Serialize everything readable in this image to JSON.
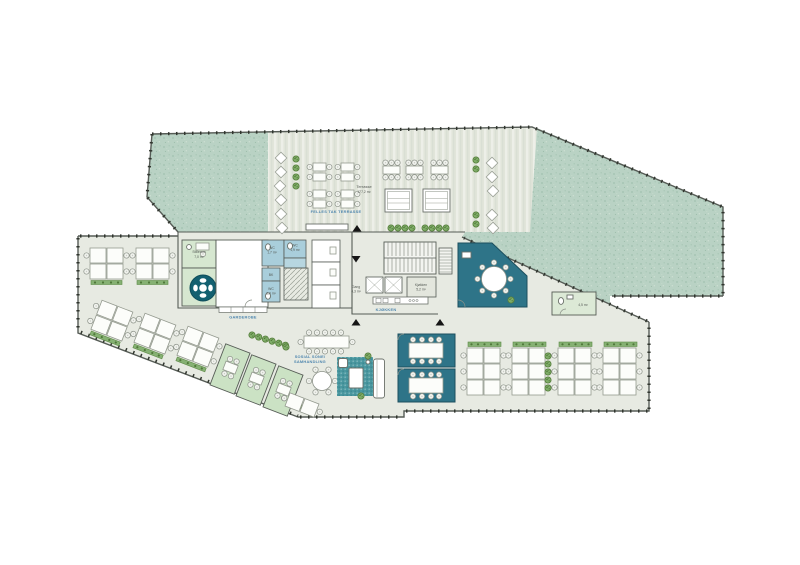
{
  "colors": {
    "roof_green": "#b9d2c4",
    "terrace_floor": "#e1e5da",
    "interior_floor": "#e7eae2",
    "meeting_teal": "#2e7488",
    "meeting_teal_dark": "#136070",
    "rug_teal": "#4b98a0",
    "wc_blue": "#a9cedb",
    "room_green": "#d6e7d0",
    "room_green_deep": "#cbe2c4",
    "plant_green": "#7fad68",
    "label_blue": "#4f86ae",
    "wall": "#565c56"
  },
  "labels": {
    "terrace": {
      "name": "Terrasse",
      "area": "177,2 m²"
    },
    "zones": {
      "terrace": "FELLES TAK TERRASSE",
      "wardrobe": "GARDEROBE",
      "kitchen": "KJØKKEN",
      "social_1": "SOSIAL SONE/",
      "social_2": "SAMHANDLING"
    },
    "rooms": {
      "quiet": {
        "name": "Stillerom",
        "area": "7,0 m²"
      },
      "kitchen": {
        "name": "Kjøkken",
        "area": "5,2 m²"
      },
      "wc_a": {
        "name": "WC",
        "area": "1,7 m²"
      },
      "wc_b": {
        "name": "WC",
        "area": "1,9 m²"
      },
      "wc_c": {
        "name": "WC",
        "area": "2,0 m²"
      },
      "bk": {
        "name": "BK"
      },
      "hall": {
        "name": "Gang",
        "area": "4,3 m²"
      },
      "wc_hc": {
        "name": "",
        "area": "4,5 m²"
      }
    }
  }
}
